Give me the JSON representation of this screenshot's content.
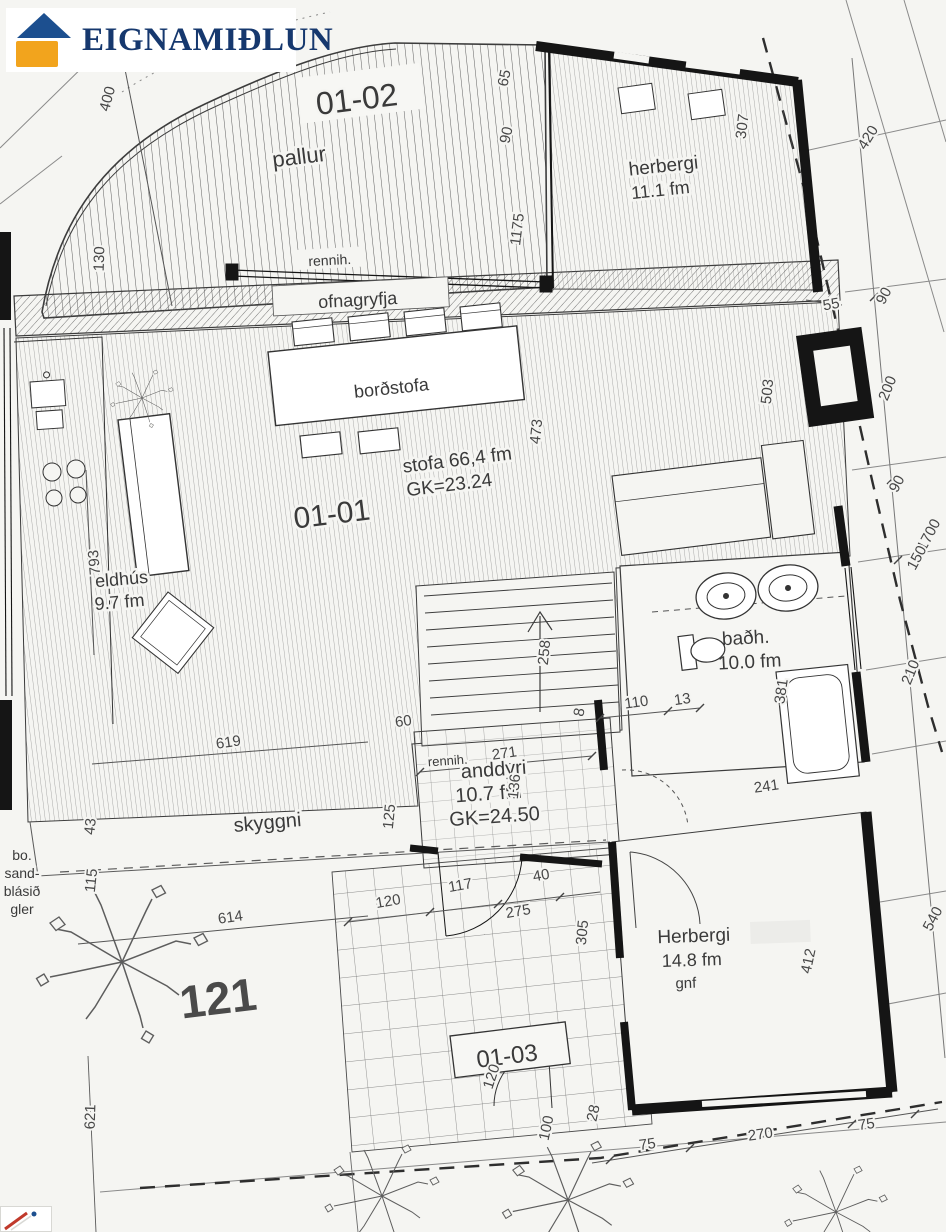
{
  "logo": {
    "title": "EIGNAMIÐLUN",
    "roof_color": "#1c4f8f",
    "body_color": "#f2a41d",
    "text_color": "#16386e"
  },
  "units": {
    "u0102": "01-02",
    "u0101": "01-01",
    "u0103": "01-03"
  },
  "rooms": {
    "pallur": "pallur",
    "herbergi1": "herbergi",
    "herbergi1_area": "11.1 fm",
    "rennih_top": "rennih.",
    "ofnagryfja": "ofnagryfja",
    "bordstofa": "borðstofa",
    "stofa": "stofa 66,4 fm",
    "stofa_gk": "GK=23.24",
    "eldhus": "eldhús",
    "eldhus_area": "9.7 fm",
    "badh": "baðh.",
    "badh_area": "10.0 fm",
    "rennih2": "rennih.",
    "anddyri": "anddyri",
    "anddyri_area": "10.7 fm",
    "anddyri_gk": "GK=24.50",
    "skyggni": "skyggni",
    "bo1": "bo.",
    "bo2": "sand-",
    "bo3": "blásið",
    "bo4": "gler",
    "herbergi2": "Herbergi",
    "herbergi2_area": "14.8 fm",
    "herbergi2_note": "gnf"
  },
  "house_number": "121",
  "dims": [
    "400",
    "130",
    "65",
    "90",
    "1175",
    "307",
    "420",
    "55",
    "90",
    "200",
    "503",
    "473",
    "793",
    "1700",
    "90",
    "150",
    "210",
    "258",
    "381",
    "241",
    "110",
    "13",
    "8",
    "271",
    "60",
    "136",
    "619",
    "125",
    "43",
    "115",
    "614",
    "120",
    "117",
    "40",
    "275",
    "305",
    "412",
    "540",
    "621",
    "100",
    "28",
    "75",
    "270",
    "75",
    "120"
  ]
}
